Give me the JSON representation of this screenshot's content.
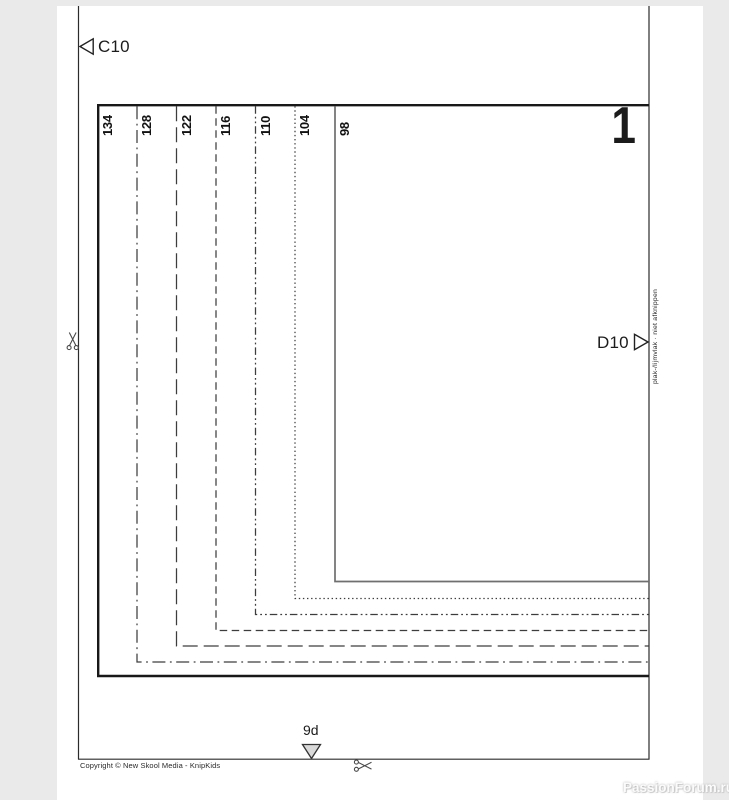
{
  "colors": {
    "background": "#ebeaea",
    "paper": "#ffffff",
    "frame_line": "#181818",
    "cut_line": "#2b2b2b",
    "size_line": "#3d3d3d",
    "size_line_98": "#6f6f6f",
    "triangle_fill": "#ffffff",
    "notch_triangle_fill": "#d9d9d9"
  },
  "markers": {
    "c10": "C10",
    "d10": "D10",
    "notch": "9d"
  },
  "piece_number": "1",
  "edge_note": "plak-/lijmvlak · niet afknippen",
  "sizes": [
    {
      "label": "134",
      "line_style": "solid-frame"
    },
    {
      "label": "128",
      "line_style": "dash-dot"
    },
    {
      "label": "122",
      "line_style": "long-dash"
    },
    {
      "label": "116",
      "line_style": "dash"
    },
    {
      "label": "110",
      "line_style": "dash-dot-dot"
    },
    {
      "label": "104",
      "line_style": "dotted"
    },
    {
      "label": "98",
      "line_style": "solid-thin"
    }
  ],
  "footer": {
    "copyright": "Copyright © New Skool Media - KnipKids"
  },
  "watermark": "PassionForum.ru"
}
